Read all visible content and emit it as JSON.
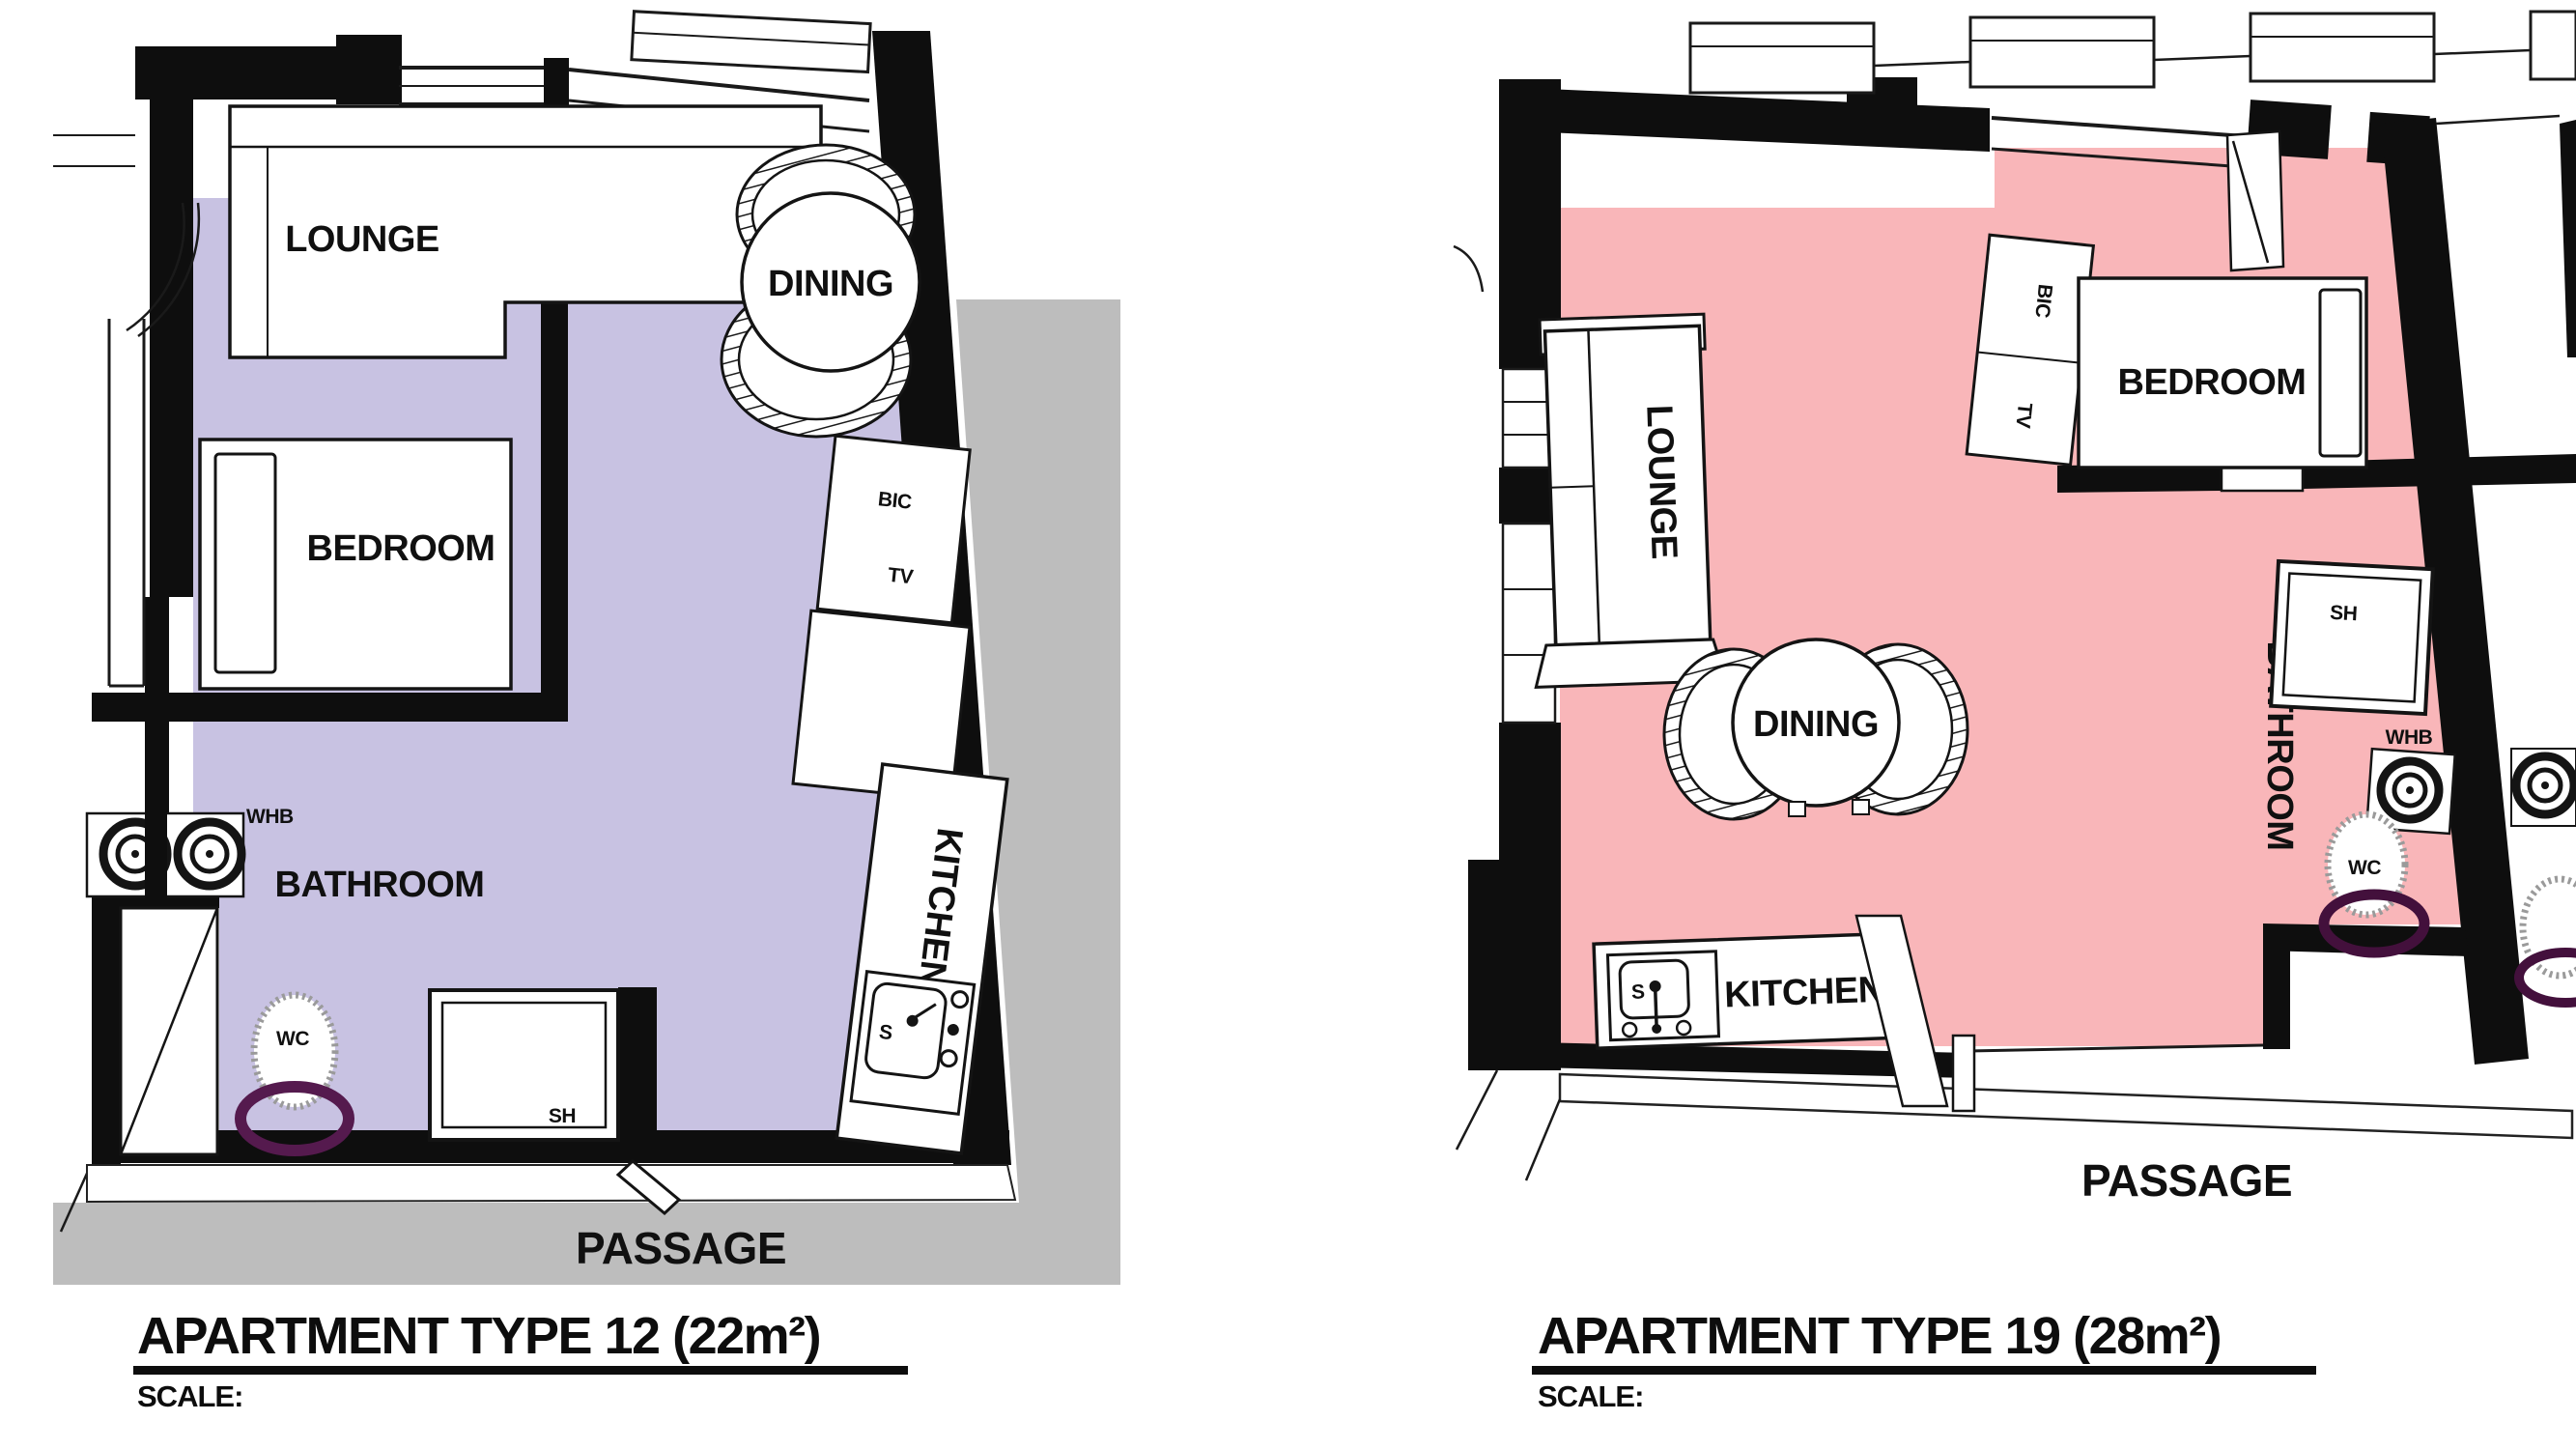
{
  "left_plan": {
    "title": "APARTMENT TYPE 12 (22m²)",
    "scale_label": "SCALE:",
    "floor_color": "#c8c2e2",
    "exterior_color": "#bdbdbd",
    "seat_color": "#551a4e",
    "labels": {
      "lounge": "LOUNGE",
      "dining": "DINING",
      "bedroom": "BEDROOM",
      "bathroom": "BATHROOM",
      "kitchen": "KITCHEN",
      "passage": "PASSAGE",
      "whb": "WHB",
      "wc": "WC",
      "sh": "SH",
      "bic": "BIC",
      "tv": "TV",
      "sink": "S"
    }
  },
  "right_plan": {
    "title": "APARTMENT TYPE 19 (28m²)",
    "scale_label": "SCALE:",
    "floor_color": "#f9b6b9",
    "seat_color": "#43103c",
    "labels": {
      "lounge": "LOUNGE",
      "dining": "DINING",
      "bedroom": "BEDROOM",
      "bathroom": "BATHROOM",
      "kitchen": "KITCHEN",
      "passage": "PASSAGE",
      "whb": "WHB",
      "wc": "WC",
      "sh": "SH",
      "bic": "BIC",
      "tv": "TV",
      "sink": "S"
    }
  }
}
